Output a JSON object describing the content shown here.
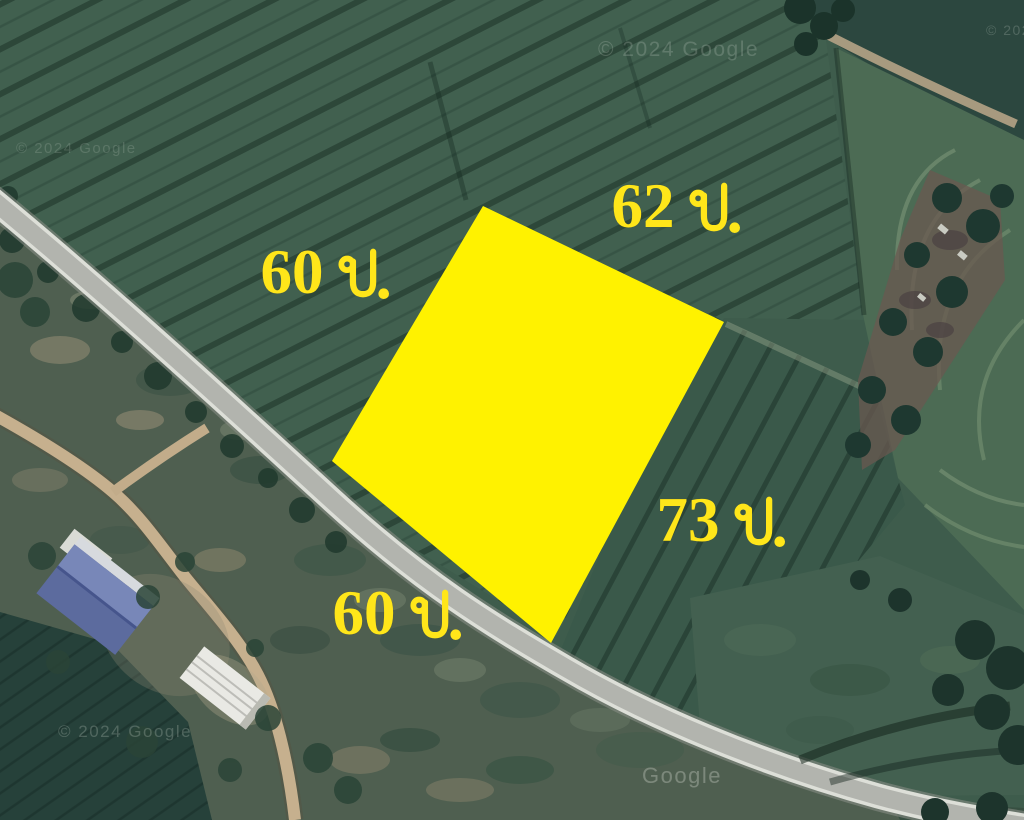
{
  "title": "Satellite map of land plot for sale with dimension overlay",
  "theme": {
    "plot_yellow": "#FFF200",
    "label_yellow": "#FFE61A",
    "road_gray": "#b2b4ae",
    "field_green": "#3e5c4c",
    "dirt_tan": "#c6b08e"
  },
  "overlay": {
    "polygon_points": "483,206 724,322 551,643 332,461",
    "unit_meaning": "ม. = meters",
    "labels": [
      {
        "text": "60 ม.",
        "value": "60",
        "unit": "ม.",
        "side": "northwest"
      },
      {
        "text": "62 ม.",
        "value": "62",
        "unit": "ม.",
        "side": "northeast"
      },
      {
        "text": "73 ม.",
        "value": "73",
        "unit": "ม.",
        "side": "southeast"
      },
      {
        "text": "60 ม.",
        "value": "60",
        "unit": "ม.",
        "side": "southwest"
      }
    ]
  },
  "watermarks": [
    {
      "text": "© 2024 Google",
      "position": "top-center"
    },
    {
      "text": "© 2024 Google",
      "position": "left"
    },
    {
      "text": "© 2024 Google",
      "position": "bottom-left"
    },
    {
      "text": "Google",
      "position": "bottom-center-road"
    },
    {
      "text": "© 202",
      "position": "top-right-clipped"
    }
  ]
}
